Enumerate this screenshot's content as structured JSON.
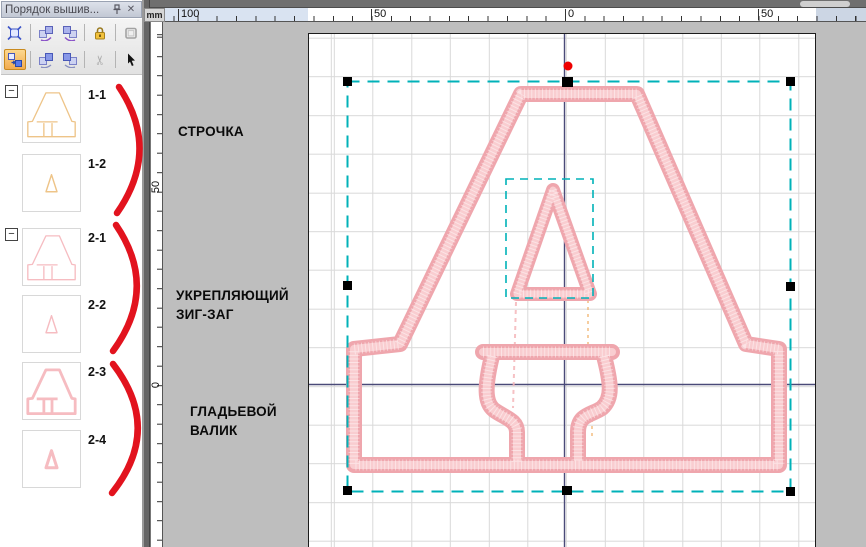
{
  "panel": {
    "title": "Порядок вышив...",
    "window_icons": [
      "pin-icon",
      "close-icon"
    ],
    "toolbar_row1": [
      "fit-selection",
      "rotate-back",
      "rotate-forward",
      "lock",
      "hoop"
    ],
    "toolbar_row2": [
      "resequence",
      "sequence-back",
      "sequence-forward",
      "cut",
      "pointer"
    ],
    "items": [
      {
        "label": "1-1",
        "group": "1",
        "shape": "letter-outline",
        "color": "tan"
      },
      {
        "label": "1-2",
        "shape": "triangle-outline",
        "color": "tan"
      },
      {
        "label": "2-1",
        "group": "2",
        "shape": "letter-outline",
        "color": "pink"
      },
      {
        "label": "2-2",
        "shape": "triangle-outline",
        "color": "pink"
      },
      {
        "label": "2-3",
        "shape": "letter-thick",
        "color": "pink"
      },
      {
        "label": "2-4",
        "shape": "triangle-thick",
        "color": "pink"
      }
    ]
  },
  "rulers": {
    "unit": "mm",
    "top": [
      "100",
      "50",
      "0",
      "50"
    ],
    "left": [
      "50",
      "0"
    ]
  },
  "annotations": [
    {
      "lines": [
        "СТРОЧКА"
      ]
    },
    {
      "lines": [
        "УКРЕПЛЯЮЩИЙ",
        "ЗИГ-ЗАГ"
      ]
    },
    {
      "lines": [
        "ГЛАДЬЕВОЙ",
        "ВАЛИК"
      ]
    }
  ],
  "colors": {
    "selection_teal": "#00b2b8",
    "stitch_pink": "#efa6ad",
    "stitch_tan": "#eec488",
    "annotation_red": "#e2131e",
    "axis_navy": "#4a4a78",
    "start_point_red": "#ee0000"
  }
}
